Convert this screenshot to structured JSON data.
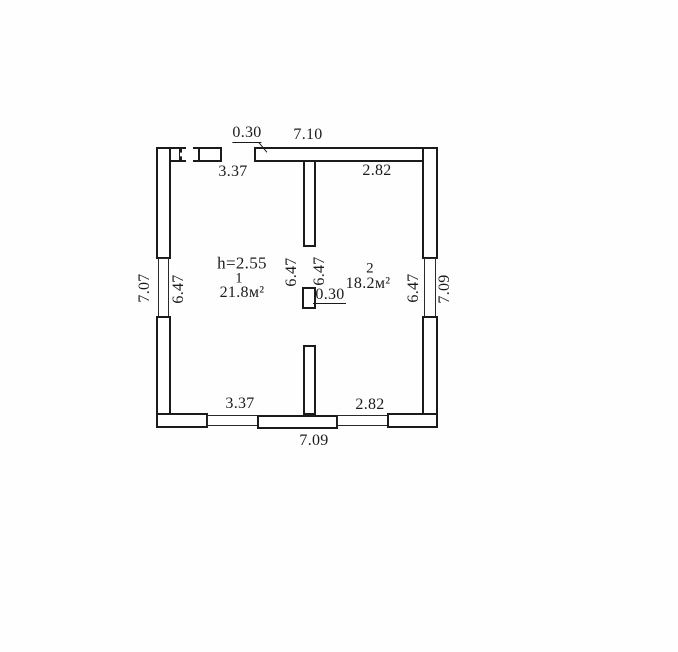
{
  "colors": {
    "line": "#1b1b1b",
    "background": "#ffffff"
  },
  "plan": {
    "height_note": "h=2.55",
    "rooms": [
      {
        "number": "1",
        "area": "21.8м²"
      },
      {
        "number": "2",
        "area": "18.2м²"
      }
    ],
    "dims": {
      "top_wall_thickness": "0.30",
      "top_exterior": "7.10",
      "room1_top": "3.37",
      "room2_top": "2.82",
      "left_exterior": "7.07",
      "left_interior": "6.47",
      "room1_height": "6.47",
      "room2_height": "6.47",
      "partition_thickness": "0.30",
      "right_interior": "6.47",
      "right_exterior": "7.09",
      "room1_bottom": "3.37",
      "room2_bottom": "2.82",
      "bottom_exterior": "7.09"
    }
  }
}
